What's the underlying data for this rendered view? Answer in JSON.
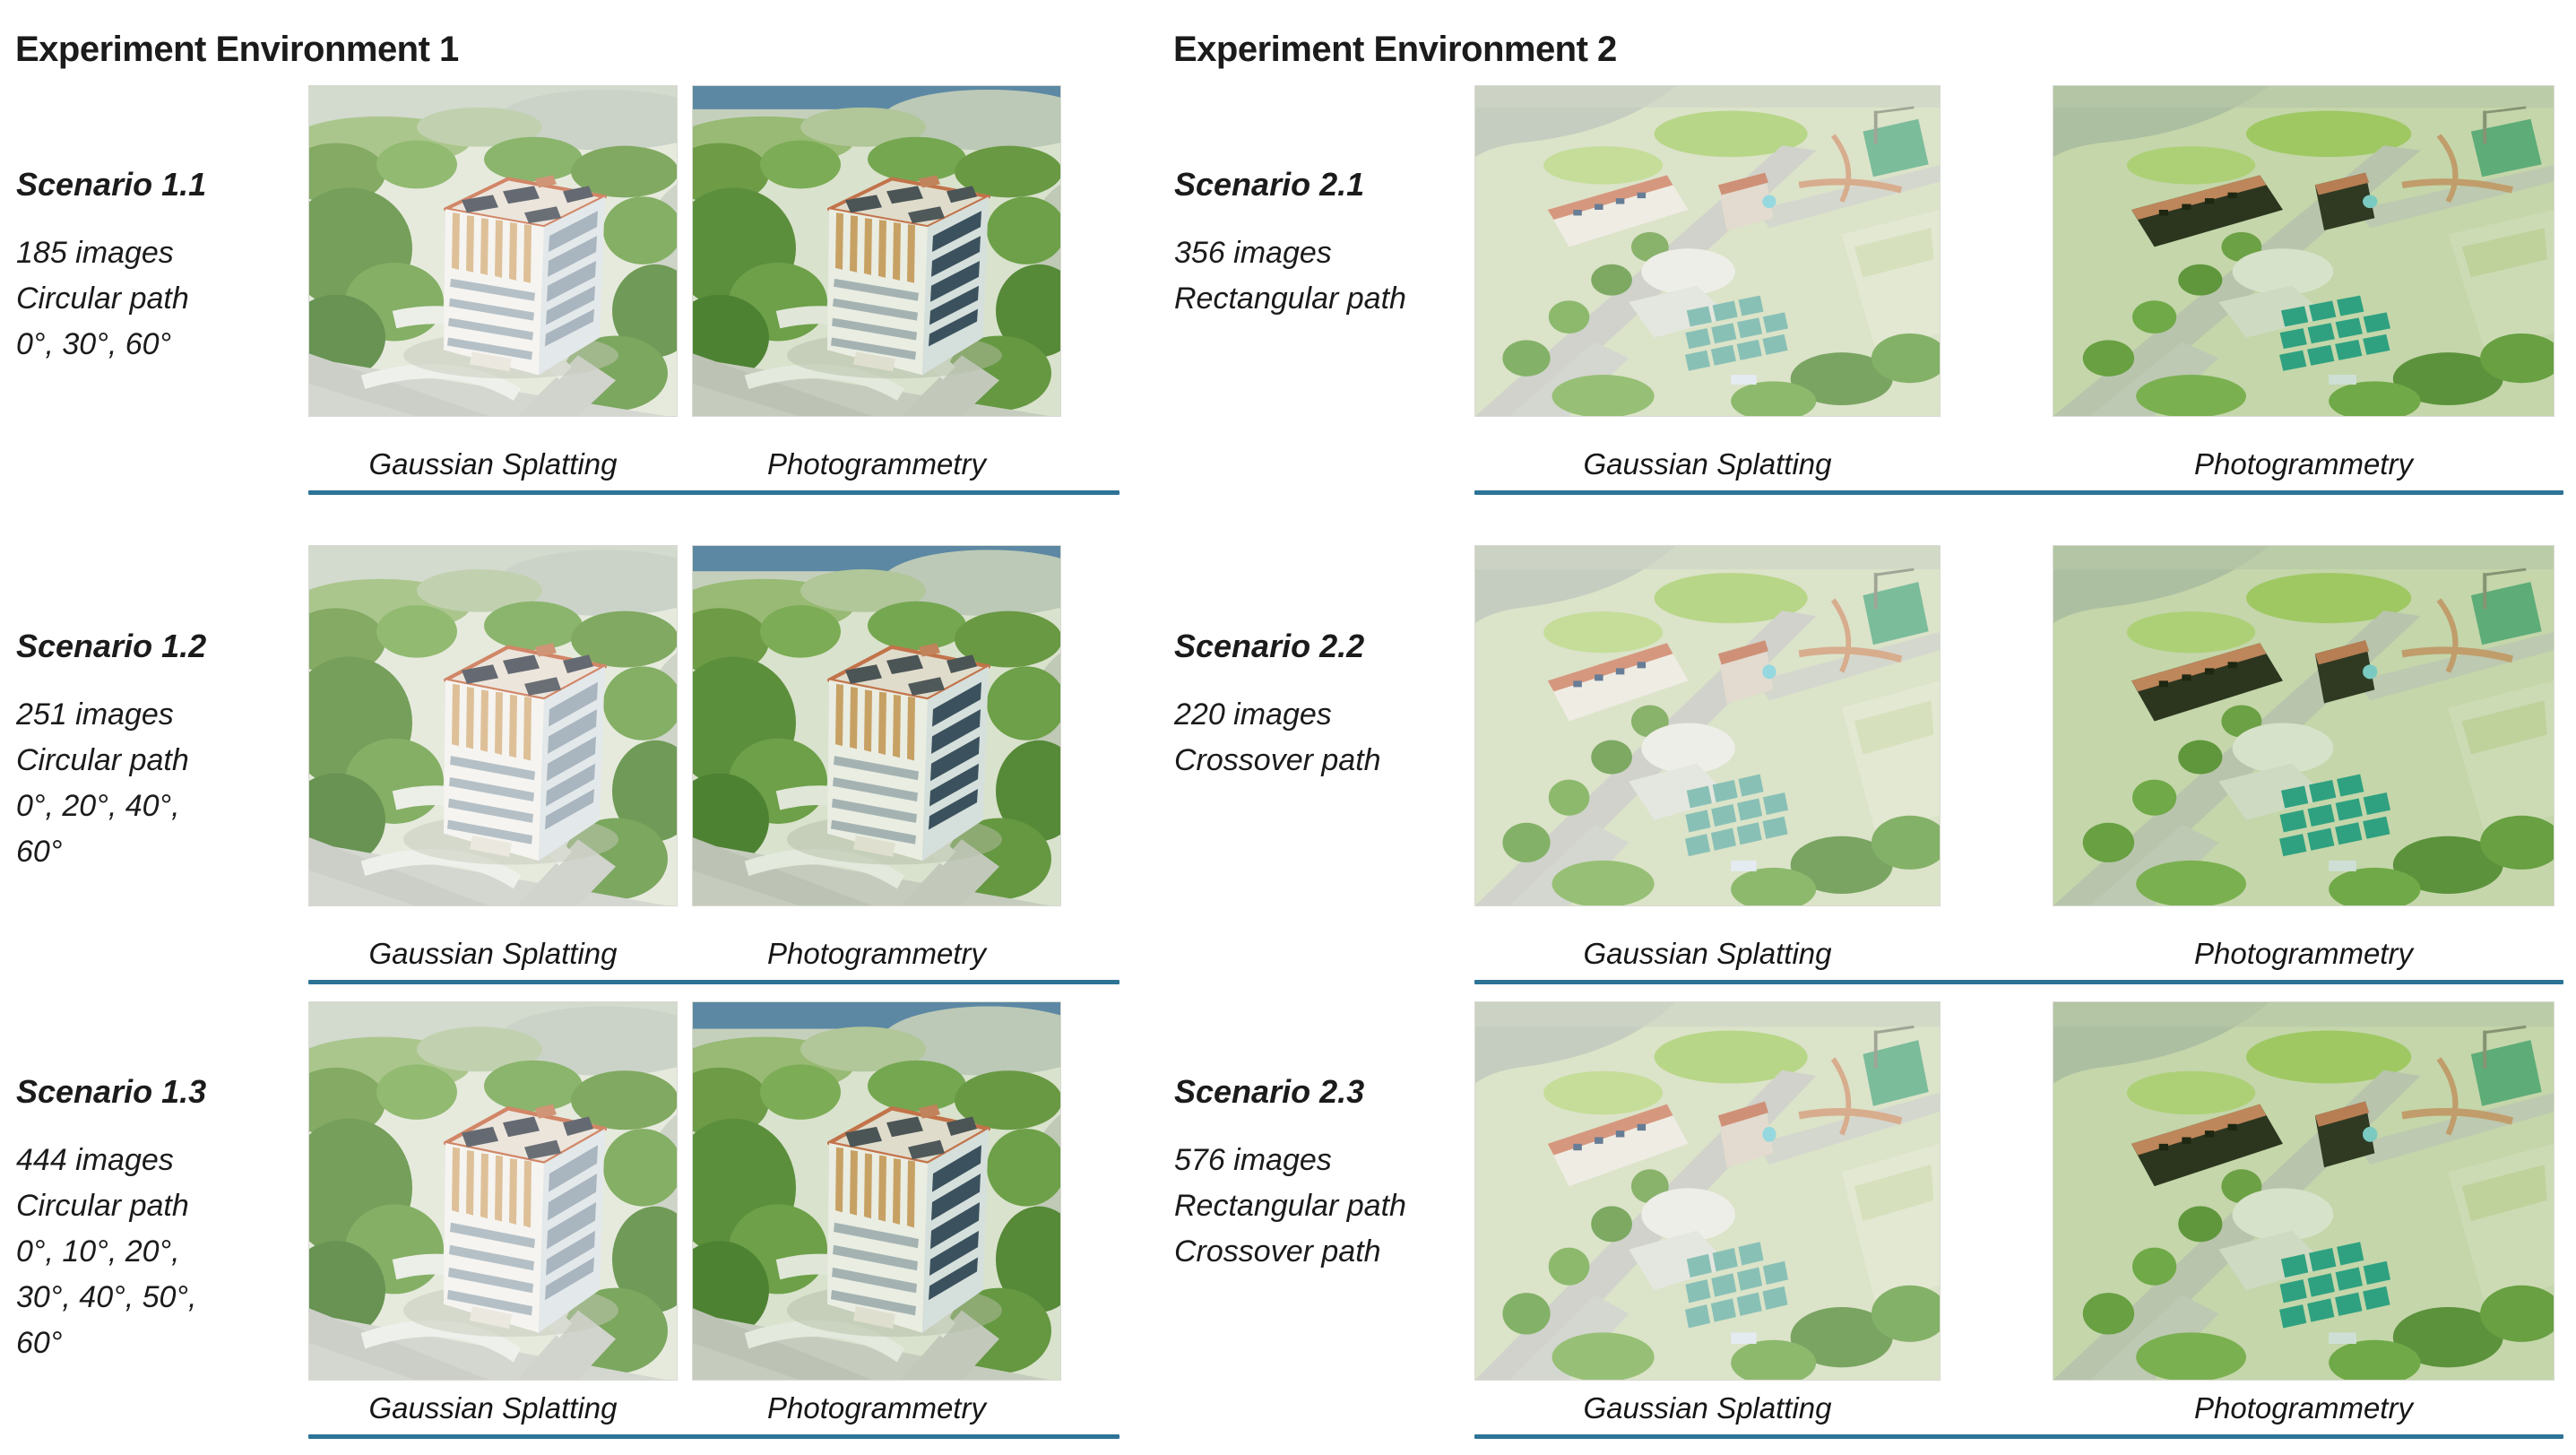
{
  "colors": {
    "divider_blue": "#2d7396",
    "text": "#1b1b1b",
    "background": "#ffffff"
  },
  "environments": [
    {
      "title": "Experiment Environment 1",
      "scenarios": [
        {
          "name": "Scenario 1.1",
          "details": [
            "185 images",
            "Circular path",
            "0°, 30°, 60°"
          ],
          "images": [
            {
              "caption": "Gaussian Splatting",
              "alt": "Aerial Gaussian Splatting reconstruction of high-rise building"
            },
            {
              "caption": "Photogrammetry",
              "alt": "Aerial photogrammetry reconstruction of high-rise building"
            }
          ]
        },
        {
          "name": "Scenario 1.2",
          "details": [
            "251 images",
            "Circular path",
            "0°, 20°, 40°, 60°"
          ],
          "images": [
            {
              "caption": "Gaussian Splatting",
              "alt": "Aerial Gaussian Splatting reconstruction of high-rise building"
            },
            {
              "caption": "Photogrammetry",
              "alt": "Aerial photogrammetry reconstruction of high-rise building"
            }
          ]
        },
        {
          "name": "Scenario 1.3",
          "details": [
            "444 images",
            "Circular path",
            "0°, 10°, 20°, 30°, 40°, 50°, 60°"
          ],
          "images": [
            {
              "caption": "Gaussian Splatting",
              "alt": "Aerial Gaussian Splatting reconstruction of high-rise building"
            },
            {
              "caption": "Photogrammetry",
              "alt": "Aerial photogrammetry reconstruction of high-rise building"
            }
          ]
        }
      ]
    },
    {
      "title": "Experiment Environment 2",
      "scenarios": [
        {
          "name": "Scenario 2.1",
          "details": [
            "356 images",
            "Rectangular path"
          ],
          "images": [
            {
              "caption": "Gaussian Splatting",
              "alt": "Aerial Gaussian Splatting reconstruction of campus area"
            },
            {
              "caption": "Photogrammetry",
              "alt": "Aerial photogrammetry reconstruction of campus area"
            }
          ]
        },
        {
          "name": "Scenario 2.2",
          "details": [
            "220 images",
            "Crossover path"
          ],
          "images": [
            {
              "caption": "Gaussian Splatting",
              "alt": "Aerial Gaussian Splatting reconstruction of campus area"
            },
            {
              "caption": "Photogrammetry",
              "alt": "Aerial photogrammetry reconstruction of campus area"
            }
          ]
        },
        {
          "name": "Scenario 2.3",
          "details": [
            "576 images",
            "Rectangular path",
            "Crossover path"
          ],
          "images": [
            {
              "caption": "Gaussian Splatting",
              "alt": "Aerial Gaussian Splatting reconstruction of campus area"
            },
            {
              "caption": "Photogrammetry",
              "alt": "Aerial photogrammetry reconstruction of campus area"
            }
          ]
        }
      ]
    }
  ]
}
